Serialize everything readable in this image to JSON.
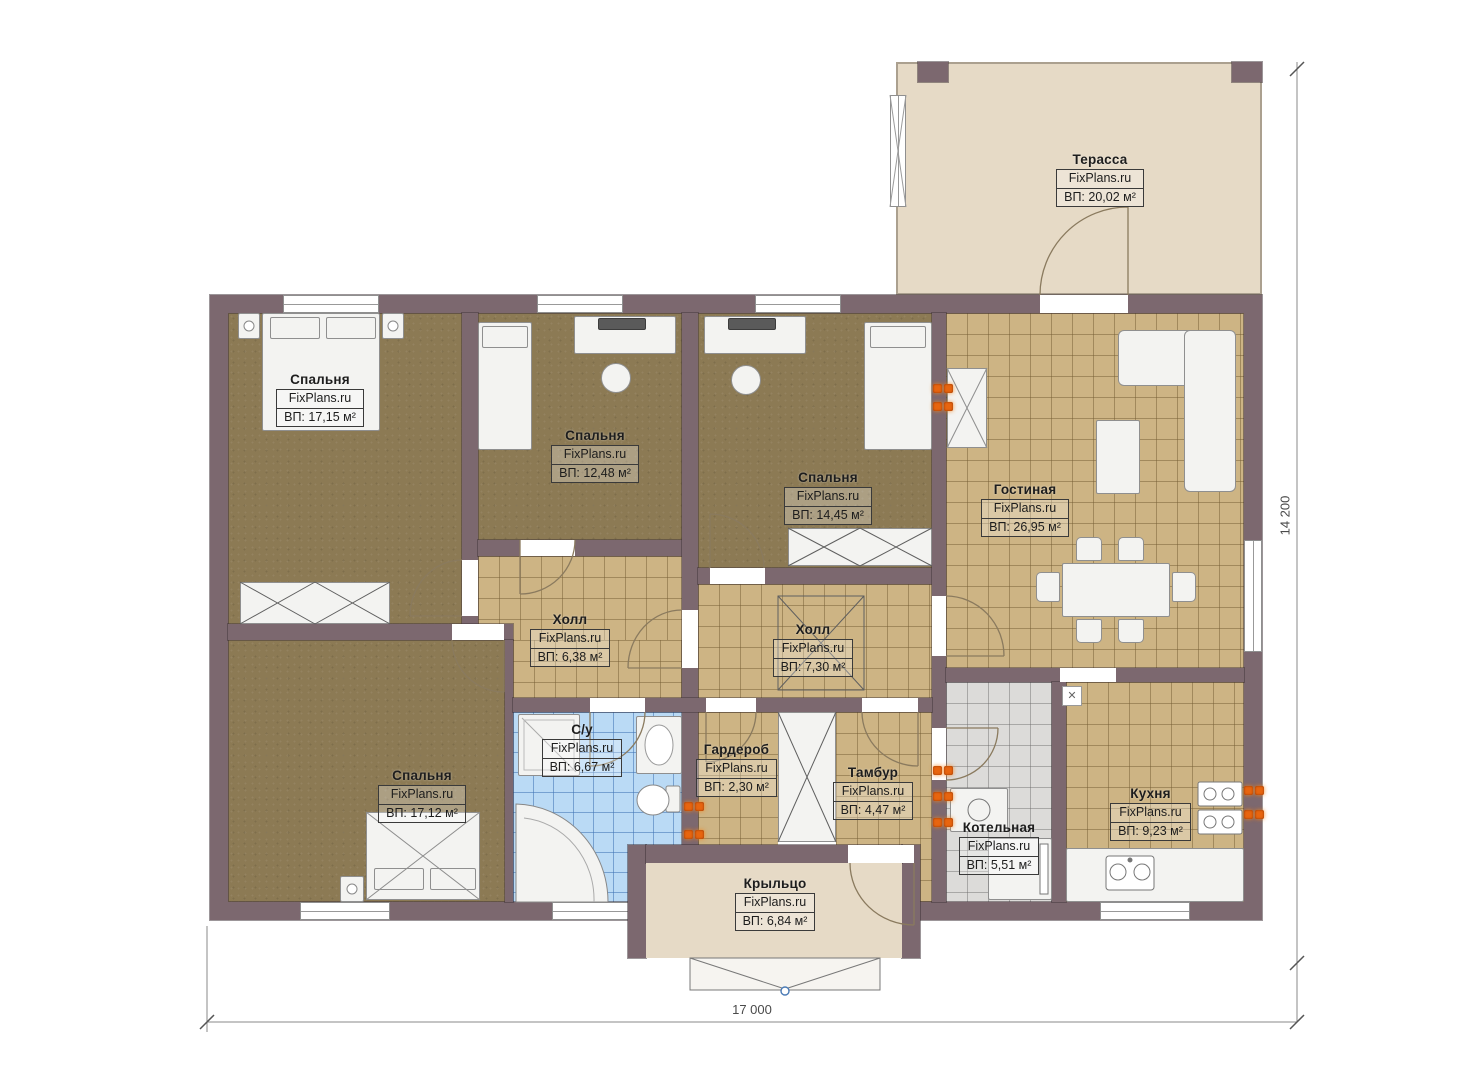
{
  "plan": {
    "brand": "FixPlans.ru",
    "type": "single-storey house floor plan"
  },
  "rooms": {
    "terrace": {
      "name": "Терасса",
      "brand": "FixPlans.ru",
      "area": "ВП: 20,02 м²"
    },
    "bedroom_top_left": {
      "name": "Спальня",
      "brand": "FixPlans.ru",
      "area": "ВП: 17,15 м²"
    },
    "bedroom_top_mid": {
      "name": "Спальня",
      "brand": "FixPlans.ru",
      "area": "ВП: 12,48 м²"
    },
    "bedroom_top_right": {
      "name": "Спальня",
      "brand": "FixPlans.ru",
      "area": "ВП: 14,45 м²"
    },
    "living_room": {
      "name": "Гостиная",
      "brand": "FixPlans.ru",
      "area": "ВП: 26,95 м²"
    },
    "hall_left": {
      "name": "Холл",
      "brand": "FixPlans.ru",
      "area": "ВП: 6,38 м²"
    },
    "hall_right": {
      "name": "Холл",
      "brand": "FixPlans.ru",
      "area": "ВП: 7,30 м²"
    },
    "bathroom": {
      "name": "С/у",
      "brand": "FixPlans.ru",
      "area": "ВП: 6,67 м²"
    },
    "wardrobe": {
      "name": "Гардероб",
      "brand": "FixPlans.ru",
      "area": "ВП: 2,30 м²"
    },
    "vestibule": {
      "name": "Тамбур",
      "brand": "FixPlans.ru",
      "area": "ВП: 4,47 м²"
    },
    "boiler_room": {
      "name": "Котельная",
      "brand": "FixPlans.ru",
      "area": "ВП: 5,51 м²"
    },
    "kitchen": {
      "name": "Кухня",
      "brand": "FixPlans.ru",
      "area": "ВП: 9,23 м²"
    },
    "bedroom_bottom_left": {
      "name": "Спальня",
      "brand": "FixPlans.ru",
      "area": "ВП: 17,12 м²"
    },
    "porch": {
      "name": "Крыльцо",
      "brand": "FixPlans.ru",
      "area": "ВП: 6,84 м²"
    }
  },
  "dimensions": {
    "width_label": "17 000",
    "height_label": "14 200"
  },
  "colors": {
    "wall": "#7c686f",
    "carpet": "#8c7a54",
    "tile_tan": "#cdb484",
    "tile_blue": "#badaf5",
    "tile_gray": "#dcdbd9",
    "beige": "#e6dac6",
    "radiator": "#e8650f"
  }
}
